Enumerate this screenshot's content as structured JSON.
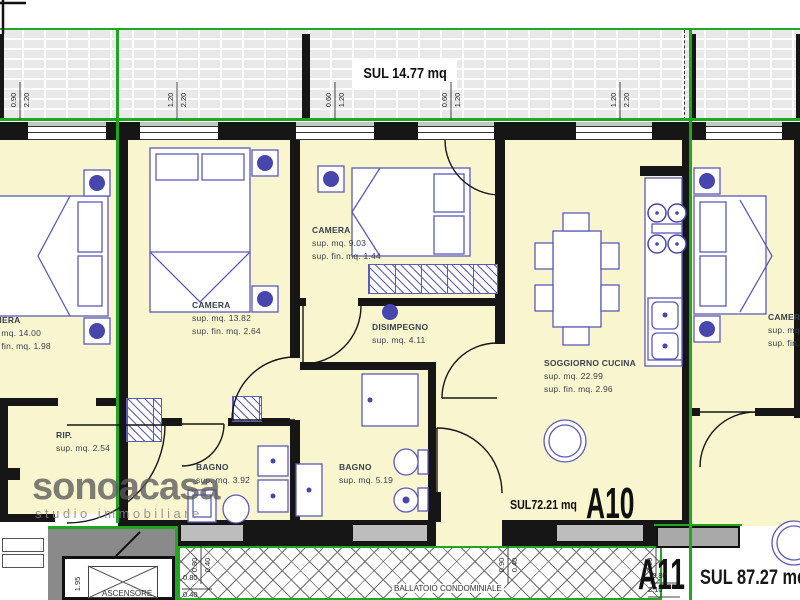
{
  "colors": {
    "green": "#1fa81f",
    "cream": "#f9f5cf",
    "wall": "#161616",
    "furniture": "#5b5bb8",
    "furniture_dark": "#4646ac",
    "gray_wall": "#bdbdbd",
    "dark_gray": "#8a8a8a",
    "label": "#39424e"
  },
  "balcony": {
    "sul_label": "SUL 14.77 mq"
  },
  "apartment": {
    "id": "A10",
    "sul_label": "SUL72.21 mq"
  },
  "neighbor": {
    "id": "A11",
    "sul_label": "SUL 87.27 mq"
  },
  "common": {
    "ballatoio": "BALLATOIO CONDOMINIALE",
    "ascensore": "ASCENSORE"
  },
  "watermark": {
    "brand": "sonoacasa",
    "tagline": "studio immobiliare"
  },
  "rooms": [
    {
      "name": "CAMERA",
      "lines": [
        "sup. mq. 13.82",
        "sup. fin. mq. 2.64"
      ],
      "x": 192,
      "y": 299
    },
    {
      "name": "CAMERA",
      "lines": [
        "sup. mq. 9.03",
        "sup. fin. mq. 1.44"
      ],
      "x": 312,
      "y": 224
    },
    {
      "name": "DISIMPEGNO",
      "lines": [
        "sup. mq. 4.11"
      ],
      "x": 372,
      "y": 321
    },
    {
      "name": "SOGGIORNO CUCINA",
      "lines": [
        "sup. mq. 22.99",
        "sup. fin. mq. 2.96"
      ],
      "x": 544,
      "y": 357
    },
    {
      "name": "BAGNO",
      "lines": [
        "sup. mq. 3.92"
      ],
      "x": 196,
      "y": 461
    },
    {
      "name": "BAGNO",
      "lines": [
        "sup. mq. 5.19"
      ],
      "x": 339,
      "y": 461
    },
    {
      "name": "RIP.",
      "lines": [
        "sup. mq. 2.54"
      ],
      "x": 56,
      "y": 429
    },
    {
      "name": "CAMERA",
      "lines": [
        "sup. mq. 14.00",
        "sup. fin. mq. 1.98"
      ],
      "x": -18,
      "y": 314
    },
    {
      "name": "CAMERA",
      "lines": [
        "sup. mq.",
        "sup. fin."
      ],
      "x": 768,
      "y": 311
    }
  ],
  "dimensions": [
    {
      "t": "0.90",
      "x": 14,
      "y": 100,
      "v": 1
    },
    {
      "t": "2.20",
      "x": 27,
      "y": 100,
      "v": 1
    },
    {
      "t": "1.20",
      "x": 171,
      "y": 100,
      "v": 1
    },
    {
      "t": "2.20",
      "x": 184,
      "y": 100,
      "v": 1
    },
    {
      "t": "0.60",
      "x": 329,
      "y": 100,
      "v": 1
    },
    {
      "t": "1.20",
      "x": 342,
      "y": 100,
      "v": 1
    },
    {
      "t": "0.60",
      "x": 445,
      "y": 100,
      "v": 1
    },
    {
      "t": "1.20",
      "x": 458,
      "y": 100,
      "v": 1
    },
    {
      "t": "1.20",
      "x": 614,
      "y": 100,
      "v": 1
    },
    {
      "t": "2.20",
      "x": 627,
      "y": 100,
      "v": 1
    },
    {
      "t": "0.80",
      "x": 195,
      "y": 565,
      "v": 1
    },
    {
      "t": "0.40",
      "x": 208,
      "y": 565,
      "v": 1
    },
    {
      "t": "0.90",
      "x": 502,
      "y": 565,
      "v": 1
    },
    {
      "t": "0.40",
      "x": 515,
      "y": 565,
      "v": 1
    },
    {
      "t": "0.90",
      "x": 650,
      "y": 565,
      "v": 1
    },
    {
      "t": "0.80",
      "x": 183,
      "y": 578,
      "v": 0
    },
    {
      "t": "0.40",
      "x": 183,
      "y": 595,
      "v": 0
    },
    {
      "t": "0.80",
      "x": 652,
      "y": 576,
      "v": 0
    },
    {
      "t": "2.10",
      "x": 648,
      "y": 590,
      "v": 0
    },
    {
      "t": "1.95",
      "x": 78,
      "y": 584,
      "v": 1
    }
  ]
}
